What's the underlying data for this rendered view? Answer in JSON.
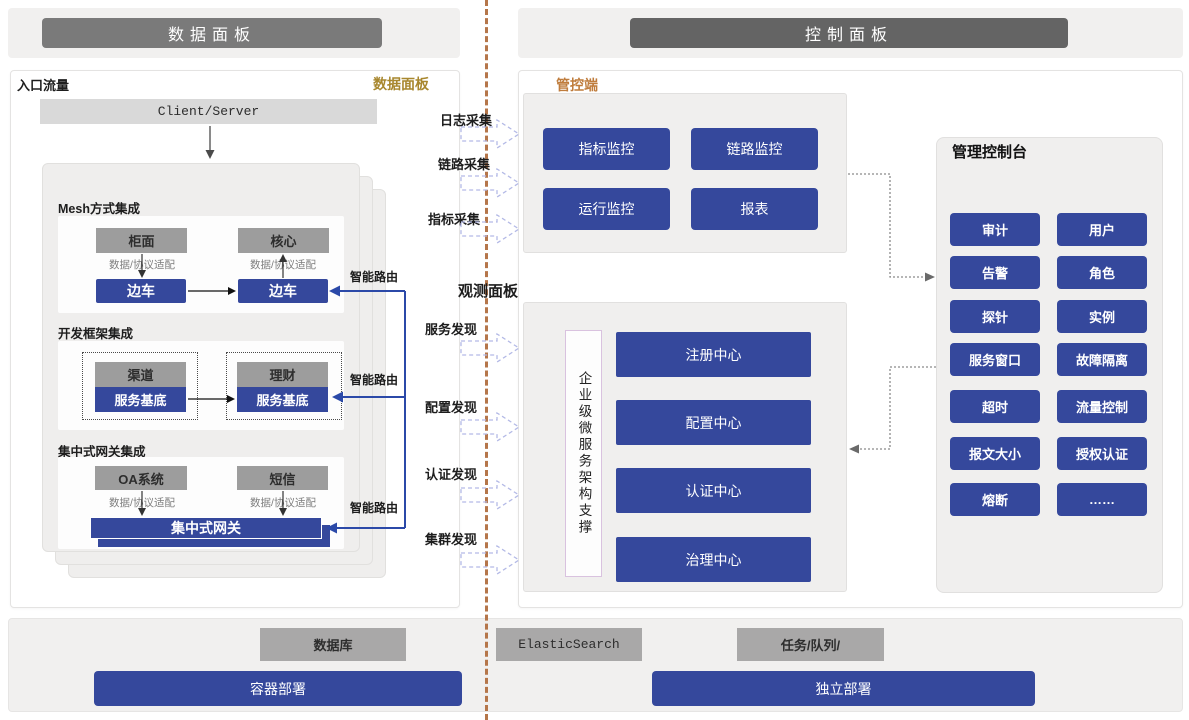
{
  "headers": {
    "left": "数据面板",
    "right": "控制面板"
  },
  "colors": {
    "accent_blue": "#35489c",
    "gray_box": "#9d9d9d",
    "header_left_gray": "#7a7a7a",
    "header_right_gray": "#646464",
    "gold_label": "#a8872e",
    "orange_label": "#bf7c3c",
    "divider_brown": "#b5764a",
    "flow_arrow_outline": "#b3b9e6"
  },
  "data_panel": {
    "entry_label": "入口流量",
    "corner_label": "数据面板",
    "client_server": "Client/Server",
    "adapter_label": "数据/协议适配",
    "smart_route_label": "智能路由",
    "mesh": {
      "title": "Mesh方式集成",
      "left_top": "柜面",
      "right_top": "核心",
      "left_bottom": "边车",
      "right_bottom": "边车"
    },
    "framework": {
      "title": "开发框架集成",
      "left_top": "渠道",
      "right_top": "理财",
      "left_bottom": "服务基底",
      "right_bottom": "服务基底"
    },
    "gateway": {
      "title": "集中式网关集成",
      "left_top": "OA系统",
      "right_top": "短信",
      "bus": "集中式网关"
    }
  },
  "flows": {
    "collect": [
      "日志采集",
      "链路采集",
      "指标采集"
    ],
    "observe_title": "观测面板",
    "discover": [
      "服务发现",
      "配置发现",
      "认证发现",
      "集群发现"
    ]
  },
  "control_panel": {
    "label": "管控端",
    "monitors": [
      "指标监控",
      "链路监控",
      "运行监控",
      "报表"
    ],
    "observe": {
      "support": "企业级微服务架构支撑",
      "centers": [
        "注册中心",
        "配置中心",
        "认证中心",
        "治理中心"
      ]
    },
    "console": {
      "title": "管理控制台",
      "buttons": [
        "审计",
        "用户",
        "告警",
        "角色",
        "探针",
        "实例",
        "服务窗口",
        "故障隔离",
        "超时",
        "流量控制",
        "报文大小",
        "授权认证",
        "熔断",
        "……"
      ]
    }
  },
  "infrastructure": {
    "gray_boxes": [
      "数据库",
      "ElasticSearch",
      "任务/队列/"
    ],
    "blue_boxes": [
      "容器部署",
      "独立部署"
    ]
  }
}
